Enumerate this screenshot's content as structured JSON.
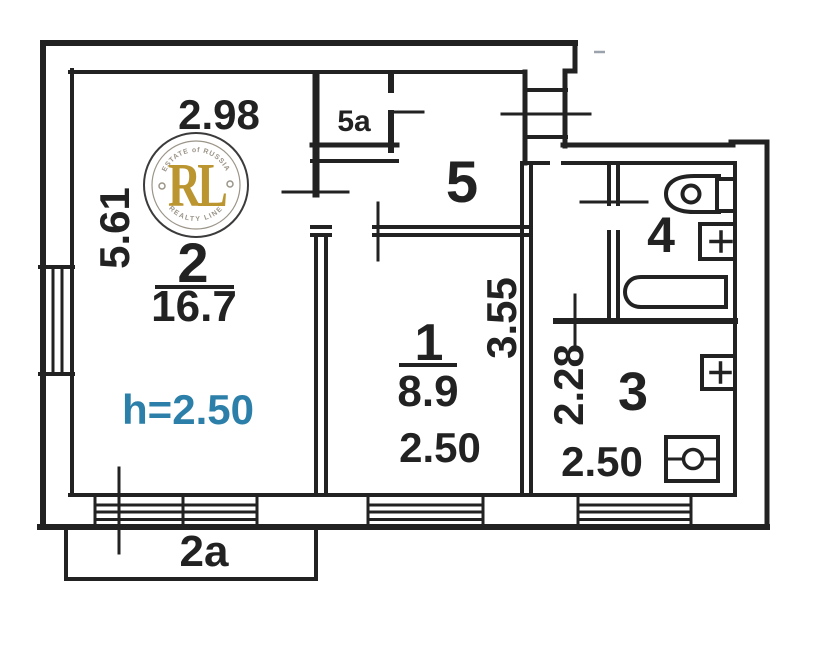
{
  "plan": {
    "room_2": {
      "number": "2",
      "area": "16.7",
      "width_dim": "2.98",
      "depth_dim": "5.61",
      "ceiling_note": "h=2.50"
    },
    "room_1": {
      "number": "1",
      "area": "8.9",
      "depth_dim": "3.55",
      "width_dim": "2.50"
    },
    "room_3": {
      "number": "3",
      "depth_dim": "2.28",
      "width_dim": "2.50"
    },
    "room_4": {
      "number": "4"
    },
    "room_5": {
      "number": "5"
    },
    "room_5a": {
      "number": "5a"
    },
    "balcony_2a": {
      "number": "2a"
    }
  },
  "stamp": {
    "arc_top": "ESTATE of RUSSIA",
    "monogram": "RL",
    "arc_bottom": "REALTY LINE"
  },
  "colors": {
    "paper": "#ffffff",
    "ink": "#222222",
    "blue": "#2b7fa8",
    "gold": "#bb9530",
    "stamp_gray": "#9b9488",
    "stamp_ring": "#3b3b3b"
  }
}
